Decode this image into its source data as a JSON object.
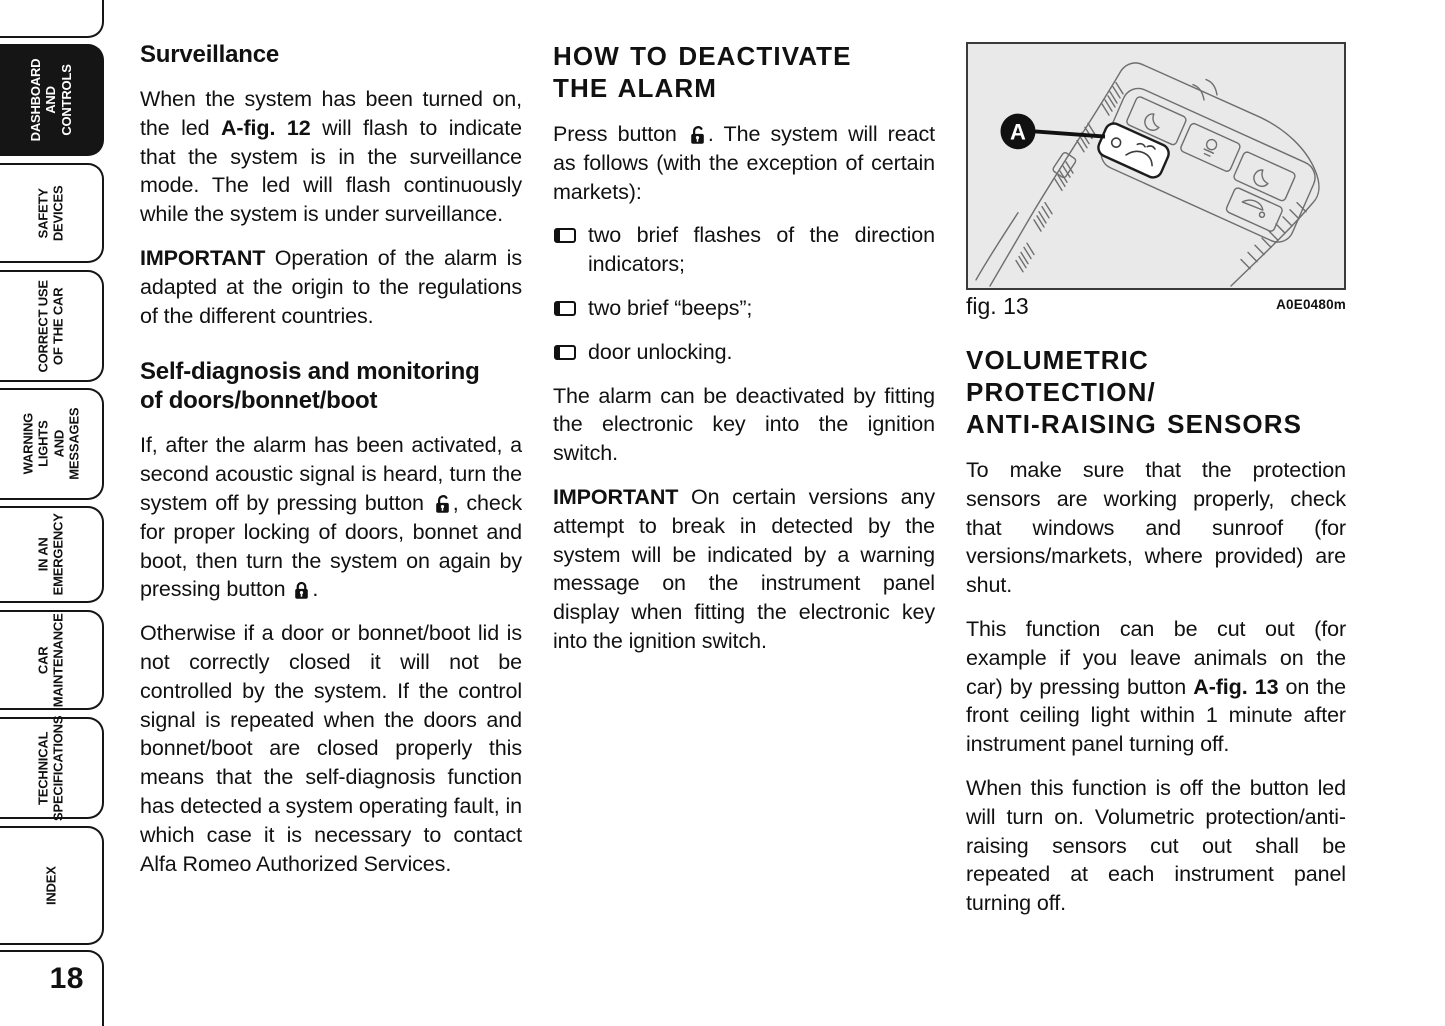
{
  "page": {
    "number": "18"
  },
  "colors": {
    "text": "#111111",
    "tab_active_bg": "#151515",
    "figure_bg": "#e9e9e9",
    "figure_line": "#6e6e6e"
  },
  "icons": {
    "bullet": "open-square-bullet",
    "lock_open": "open-padlock",
    "lock_closed": "closed-padlock",
    "callout_badge": "black-circle-letter-a"
  },
  "sidebar": {
    "tabs": [
      {
        "label": "DASHBOARD\nAND\nCONTROLS",
        "active": true
      },
      {
        "label": "SAFETY\nDEVICES",
        "active": false
      },
      {
        "label": "CORRECT USE\nOF THE CAR",
        "active": false
      },
      {
        "label": "WARNING LIGHTS\nAND MESSAGES",
        "active": false
      },
      {
        "label": "IN AN\nEMERGENCY",
        "active": false
      },
      {
        "label": "CAR\nMAINTENANCE",
        "active": false
      },
      {
        "label": "TECHNICAL\nSPECIFICATIONS",
        "active": false
      },
      {
        "label": "INDEX",
        "active": false
      }
    ]
  },
  "col1": {
    "heading": "Surveillance",
    "p1": [
      {
        "t": "When the system has been turned on, the led "
      },
      {
        "b": "A-fig. 12"
      },
      {
        "t": " will flash to indicate that the system is in the surveillance mode. The led will flash continuously while the system is under surveillance."
      }
    ],
    "p2": [
      {
        "b": "IMPORTANT"
      },
      {
        "t": " Operation of the alarm is adapted at the origin to the regulations of the different countries."
      }
    ],
    "heading2": "Self-diagnosis and monitoring\nof doors/bonnet/boot",
    "p3": [
      {
        "t": "If, after the alarm has been activated, a second acoustic signal is heard, turn the system off by pressing button "
      },
      {
        "t": ", check for proper locking of doors, bonnet and boot, then turn the system on again by pressing button "
      },
      {
        "t": "."
      }
    ],
    "p4": "Otherwise if a door or bonnet/boot lid is not correctly closed it will not be controlled by the system. If the control signal is repeated when the doors and bonnet/boot are closed properly this means that the self-diagnosis function has detected a system operating fault, in which case it is necessary to contact Alfa Romeo Authorized Services."
  },
  "col2": {
    "heading": "HOW TO DEACTIVATE\nTHE ALARM",
    "p1": [
      {
        "t": "Press button "
      },
      {
        "t": ". The system will react as follows (with the exception of certain markets):"
      }
    ],
    "bullets": [
      "two brief flashes of the direction indicators;",
      "two brief “beeps”;",
      "door unlocking."
    ],
    "p2": "The alarm can be deactivated by fitting the electronic key into the ignition switch.",
    "p3": [
      {
        "b": "IMPORTANT"
      },
      {
        "t": " On certain versions any attempt to break in detected by the system will be indicated by a warning message on the instrument panel display when fitting the electronic key into the ignition switch."
      }
    ]
  },
  "col3": {
    "figure": {
      "callout": "A",
      "caption": "fig. 13",
      "code": "A0E0480m"
    },
    "heading": "VOLUMETRIC PROTECTION/\nANTI-RAISING SENSORS",
    "p1": "To make sure that the protection sensors are working properly, check that windows and sunroof (for versions/markets, where provided) are shut.",
    "p2": [
      {
        "t": "This function can be cut out (for example if you leave animals on the car) by pressing button "
      },
      {
        "b": "A-fig. 13"
      },
      {
        "t": " on the front ceiling light within 1 minute after instrument panel turning off."
      }
    ],
    "p3": "When this function is off the button led will turn on. Volumetric protection/anti-raising sensors cut out shall be repeated at each instrument panel turning off."
  }
}
